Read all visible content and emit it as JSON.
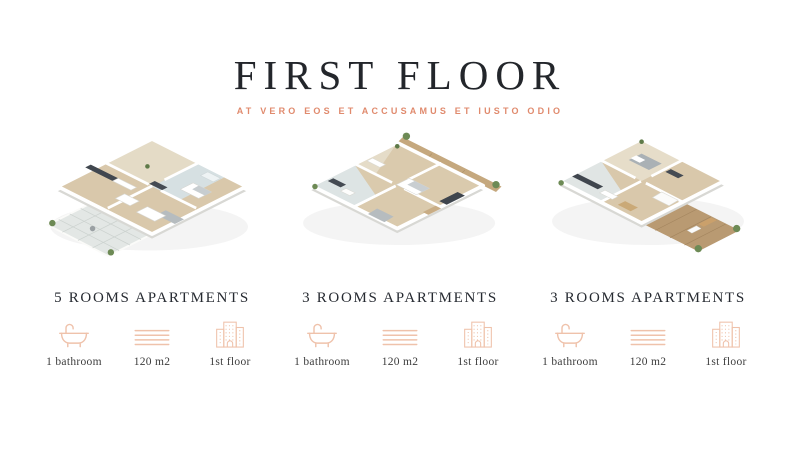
{
  "header": {
    "title": "FIRST FLOOR",
    "subtitle": "AT VERO EOS ET ACCUSAMUS ET IUSTO ODIO"
  },
  "apartments": [
    {
      "name": "5 ROOMS APARTMENTS",
      "plan_alt": "3d floor plan render with tiled terrace at bottom left",
      "features": [
        {
          "icon": "bathtub-icon",
          "label": "1 bathroom"
        },
        {
          "icon": "area-lines-icon",
          "label": "120 m2"
        },
        {
          "icon": "building-icon",
          "label": "1st floor"
        }
      ]
    },
    {
      "name": "3 ROOMS APARTMENTS",
      "plan_alt": "3d floor plan render with wooden balcony along top right",
      "features": [
        {
          "icon": "bathtub-icon",
          "label": "1 bathroom"
        },
        {
          "icon": "area-lines-icon",
          "label": "120 m2"
        },
        {
          "icon": "building-icon",
          "label": "1st floor"
        }
      ]
    },
    {
      "name": "3 ROOMS APARTMENTS",
      "plan_alt": "3d floor plan render with large wooden deck at bottom right",
      "features": [
        {
          "icon": "bathtub-icon",
          "label": "1 bathroom"
        },
        {
          "icon": "area-lines-icon",
          "label": "120 m2"
        },
        {
          "icon": "building-icon",
          "label": "1st floor"
        }
      ]
    }
  ],
  "colors": {
    "title": "#23262b",
    "subtitle_accent": "#e08a6d",
    "icon_stroke": "#efc2ab",
    "heading": "#262a31",
    "caption": "#3d3d3d",
    "wood_floor": "#d9c8ab",
    "deck_wood": "#b99a72",
    "bath_tile": "#d6e0e2",
    "plant_green": "#6d8a55"
  }
}
